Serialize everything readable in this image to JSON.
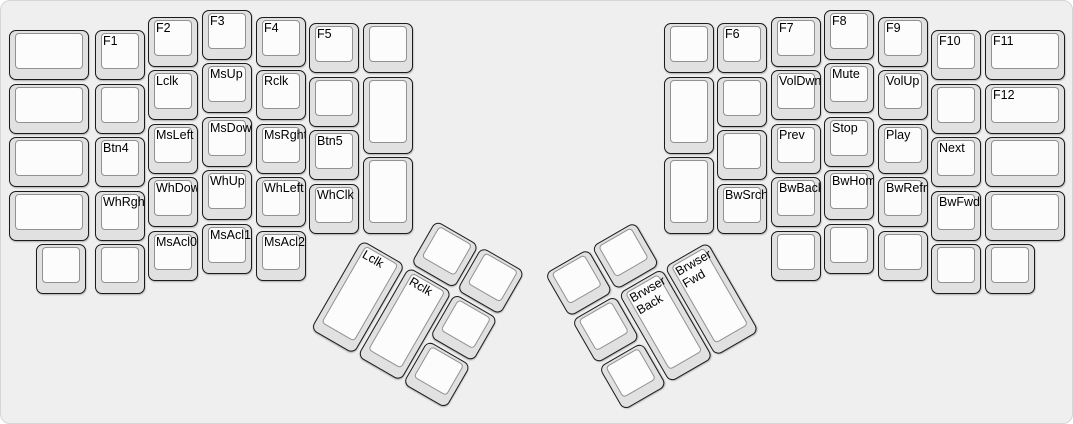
{
  "app": {
    "canvas_name": "ergodox-keyboard-layout",
    "layer_description_labels_visible": true
  },
  "colors": {
    "canvas_bg": "#efefef",
    "key_base": "#e1e1e1",
    "key_border": "#1b1b1b",
    "keycap_top": "#fcfcfc",
    "keycap_top_border": "#919191",
    "label_color": "#000000"
  },
  "main_keys": [
    {
      "name": "key-blank",
      "label": "",
      "x": 8,
      "y": 29,
      "w": 80,
      "h": 50
    },
    {
      "name": "key-blank",
      "label": "",
      "x": 8,
      "y": 83,
      "w": 80,
      "h": 50
    },
    {
      "name": "key-blank",
      "label": "",
      "x": 8,
      "y": 136,
      "w": 80,
      "h": 50
    },
    {
      "name": "key-blank",
      "label": "",
      "x": 8,
      "y": 190,
      "w": 80,
      "h": 50
    },
    {
      "name": "key-f1",
      "label": "F1",
      "x": 94,
      "y": 29,
      "w": 50,
      "h": 50
    },
    {
      "name": "key-blank",
      "label": "",
      "x": 94,
      "y": 83,
      "w": 50,
      "h": 50
    },
    {
      "name": "key-btn4",
      "label": "Btn4",
      "x": 94,
      "y": 136,
      "w": 50,
      "h": 50
    },
    {
      "name": "key-whrght",
      "label": "WhRght",
      "x": 94,
      "y": 190,
      "w": 50,
      "h": 50
    },
    {
      "name": "key-blank",
      "label": "",
      "x": 94,
      "y": 243,
      "w": 50,
      "h": 50
    },
    {
      "name": "key-f2",
      "label": "F2",
      "x": 147,
      "y": 16,
      "w": 50,
      "h": 50
    },
    {
      "name": "key-lclk",
      "label": "Lclk",
      "x": 147,
      "y": 69,
      "w": 50,
      "h": 50
    },
    {
      "name": "key-msleft",
      "label": "MsLeft",
      "x": 147,
      "y": 123,
      "w": 50,
      "h": 50
    },
    {
      "name": "key-whdown",
      "label": "WhDown",
      "x": 147,
      "y": 176,
      "w": 50,
      "h": 50
    },
    {
      "name": "key-msacl0",
      "label": "MsAcl0",
      "x": 147,
      "y": 230,
      "w": 50,
      "h": 50
    },
    {
      "name": "key-f3",
      "label": "F3",
      "x": 201,
      "y": 9,
      "w": 50,
      "h": 50
    },
    {
      "name": "key-msup",
      "label": "MsUp",
      "x": 201,
      "y": 62,
      "w": 50,
      "h": 50
    },
    {
      "name": "key-msdown",
      "label": "MsDown",
      "x": 201,
      "y": 116,
      "w": 50,
      "h": 50
    },
    {
      "name": "key-whup",
      "label": "WhUp",
      "x": 201,
      "y": 169,
      "w": 50,
      "h": 50
    },
    {
      "name": "key-msacl1",
      "label": "MsAcl1",
      "x": 201,
      "y": 223,
      "w": 50,
      "h": 50
    },
    {
      "name": "key-f4",
      "label": "F4",
      "x": 255,
      "y": 16,
      "w": 50,
      "h": 50
    },
    {
      "name": "key-rclk",
      "label": "Rclk",
      "x": 255,
      "y": 69,
      "w": 50,
      "h": 50
    },
    {
      "name": "key-msrght",
      "label": "MsRght",
      "x": 255,
      "y": 123,
      "w": 50,
      "h": 50
    },
    {
      "name": "key-whleft",
      "label": "WhLeft",
      "x": 255,
      "y": 176,
      "w": 50,
      "h": 50
    },
    {
      "name": "key-msacl2",
      "label": "MsAcl2",
      "x": 255,
      "y": 230,
      "w": 50,
      "h": 50
    },
    {
      "name": "key-f5",
      "label": "F5",
      "x": 308,
      "y": 22,
      "w": 50,
      "h": 50
    },
    {
      "name": "key-blank",
      "label": "",
      "x": 308,
      "y": 76,
      "w": 50,
      "h": 50
    },
    {
      "name": "key-btn5",
      "label": "Btn5",
      "x": 308,
      "y": 129,
      "w": 50,
      "h": 50
    },
    {
      "name": "key-whclk",
      "label": "WhClk",
      "x": 308,
      "y": 183,
      "w": 50,
      "h": 50
    },
    {
      "name": "key-blank",
      "label": "",
      "x": 362,
      "y": 22,
      "w": 50,
      "h": 50
    },
    {
      "name": "key-blank",
      "label": "",
      "x": 362,
      "y": 76,
      "w": 50,
      "h": 77
    },
    {
      "name": "key-blank",
      "label": "",
      "x": 362,
      "y": 156,
      "w": 50,
      "h": 77
    },
    {
      "name": "key-blank",
      "label": "",
      "x": 35,
      "y": 243,
      "w": 50,
      "h": 50
    },
    {
      "name": "key-blank",
      "label": "",
      "x": 663,
      "y": 22,
      "w": 50,
      "h": 50
    },
    {
      "name": "key-blank",
      "label": "",
      "x": 663,
      "y": 76,
      "w": 50,
      "h": 77
    },
    {
      "name": "key-blank",
      "label": "",
      "x": 663,
      "y": 156,
      "w": 50,
      "h": 77
    },
    {
      "name": "key-f6",
      "label": "F6",
      "x": 716,
      "y": 22,
      "w": 50,
      "h": 50
    },
    {
      "name": "key-blank",
      "label": "",
      "x": 716,
      "y": 76,
      "w": 50,
      "h": 50
    },
    {
      "name": "key-blank",
      "label": "",
      "x": 716,
      "y": 129,
      "w": 50,
      "h": 50
    },
    {
      "name": "key-bwsrch",
      "label": "BwSrch",
      "x": 716,
      "y": 183,
      "w": 50,
      "h": 50
    },
    {
      "name": "key-f7",
      "label": "F7",
      "x": 770,
      "y": 16,
      "w": 50,
      "h": 50
    },
    {
      "name": "key-voldwn",
      "label": "VolDwn",
      "x": 770,
      "y": 69,
      "w": 50,
      "h": 50
    },
    {
      "name": "key-prev",
      "label": "Prev",
      "x": 770,
      "y": 123,
      "w": 50,
      "h": 50
    },
    {
      "name": "key-bwback",
      "label": "BwBack",
      "x": 770,
      "y": 176,
      "w": 50,
      "h": 50
    },
    {
      "name": "key-blank",
      "label": "",
      "x": 770,
      "y": 230,
      "w": 50,
      "h": 50
    },
    {
      "name": "key-f8",
      "label": "F8",
      "x": 823,
      "y": 9,
      "w": 50,
      "h": 50
    },
    {
      "name": "key-mute",
      "label": "Mute",
      "x": 823,
      "y": 62,
      "w": 50,
      "h": 50
    },
    {
      "name": "key-stop",
      "label": "Stop",
      "x": 823,
      "y": 116,
      "w": 50,
      "h": 50
    },
    {
      "name": "key-bwhome",
      "label": "BwHome",
      "x": 823,
      "y": 169,
      "w": 50,
      "h": 50
    },
    {
      "name": "key-blank",
      "label": "",
      "x": 823,
      "y": 223,
      "w": 50,
      "h": 50
    },
    {
      "name": "key-f9",
      "label": "F9",
      "x": 877,
      "y": 16,
      "w": 50,
      "h": 50
    },
    {
      "name": "key-volup",
      "label": "VolUp",
      "x": 877,
      "y": 69,
      "w": 50,
      "h": 50
    },
    {
      "name": "key-play",
      "label": "Play",
      "x": 877,
      "y": 123,
      "w": 50,
      "h": 50
    },
    {
      "name": "key-bwrefr",
      "label": "BwRefr",
      "x": 877,
      "y": 176,
      "w": 50,
      "h": 50
    },
    {
      "name": "key-blank",
      "label": "",
      "x": 877,
      "y": 230,
      "w": 50,
      "h": 50
    },
    {
      "name": "key-f10",
      "label": "F10",
      "x": 930,
      "y": 29,
      "w": 50,
      "h": 50
    },
    {
      "name": "key-blank",
      "label": "",
      "x": 930,
      "y": 83,
      "w": 50,
      "h": 50
    },
    {
      "name": "key-next",
      "label": "Next",
      "x": 930,
      "y": 136,
      "w": 50,
      "h": 50
    },
    {
      "name": "key-bwfwd",
      "label": "BwFwd",
      "x": 930,
      "y": 190,
      "w": 50,
      "h": 50
    },
    {
      "name": "key-blank",
      "label": "",
      "x": 930,
      "y": 243,
      "w": 50,
      "h": 50
    },
    {
      "name": "key-f11",
      "label": "F11",
      "x": 984,
      "y": 29,
      "w": 80,
      "h": 50
    },
    {
      "name": "key-f12",
      "label": "F12",
      "x": 984,
      "y": 83,
      "w": 80,
      "h": 50
    },
    {
      "name": "key-blank",
      "label": "",
      "x": 984,
      "y": 136,
      "w": 80,
      "h": 50
    },
    {
      "name": "key-blank",
      "label": "",
      "x": 984,
      "y": 190,
      "w": 80,
      "h": 50
    },
    {
      "name": "key-blank",
      "label": "",
      "x": 984,
      "y": 243,
      "w": 50,
      "h": 50
    }
  ],
  "left_thumb": {
    "origin_x": 361,
    "origin_y": 239,
    "rotation_deg": 30,
    "keys": [
      {
        "name": "key-blank",
        "label": "",
        "x": 54,
        "y": -54,
        "w": 50,
        "h": 50
      },
      {
        "name": "key-blank",
        "label": "",
        "x": 107,
        "y": -54,
        "w": 50,
        "h": 50
      },
      {
        "name": "key-lclk-thumb",
        "label": "Lclk",
        "x": 0,
        "y": 0,
        "w": 50,
        "h": 103
      },
      {
        "name": "key-rclk-thumb",
        "label": "Rclk",
        "x": 54,
        "y": 0,
        "w": 50,
        "h": 103
      },
      {
        "name": "key-blank",
        "label": "",
        "x": 107,
        "y": 0,
        "w": 50,
        "h": 50
      },
      {
        "name": "key-blank",
        "label": "",
        "x": 107,
        "y": 54,
        "w": 50,
        "h": 50
      }
    ]
  },
  "right_thumb": {
    "origin_x": 710,
    "origin_y": 239,
    "rotation_deg": -30,
    "keys": [
      {
        "name": "key-blank",
        "label": "",
        "x": -161,
        "y": -54,
        "w": 50,
        "h": 50
      },
      {
        "name": "key-blank",
        "label": "",
        "x": -107,
        "y": -54,
        "w": 50,
        "h": 50
      },
      {
        "name": "key-blank",
        "label": "",
        "x": -161,
        "y": 0,
        "w": 50,
        "h": 50
      },
      {
        "name": "key-brwser-back",
        "label": "Brwser\nBack",
        "x": -107,
        "y": 0,
        "w": 50,
        "h": 103
      },
      {
        "name": "key-brwser-fwd",
        "label": "Brwser\nFwd",
        "x": -54,
        "y": 0,
        "w": 50,
        "h": 103
      },
      {
        "name": "key-blank",
        "label": "",
        "x": -161,
        "y": 54,
        "w": 50,
        "h": 50
      }
    ]
  }
}
